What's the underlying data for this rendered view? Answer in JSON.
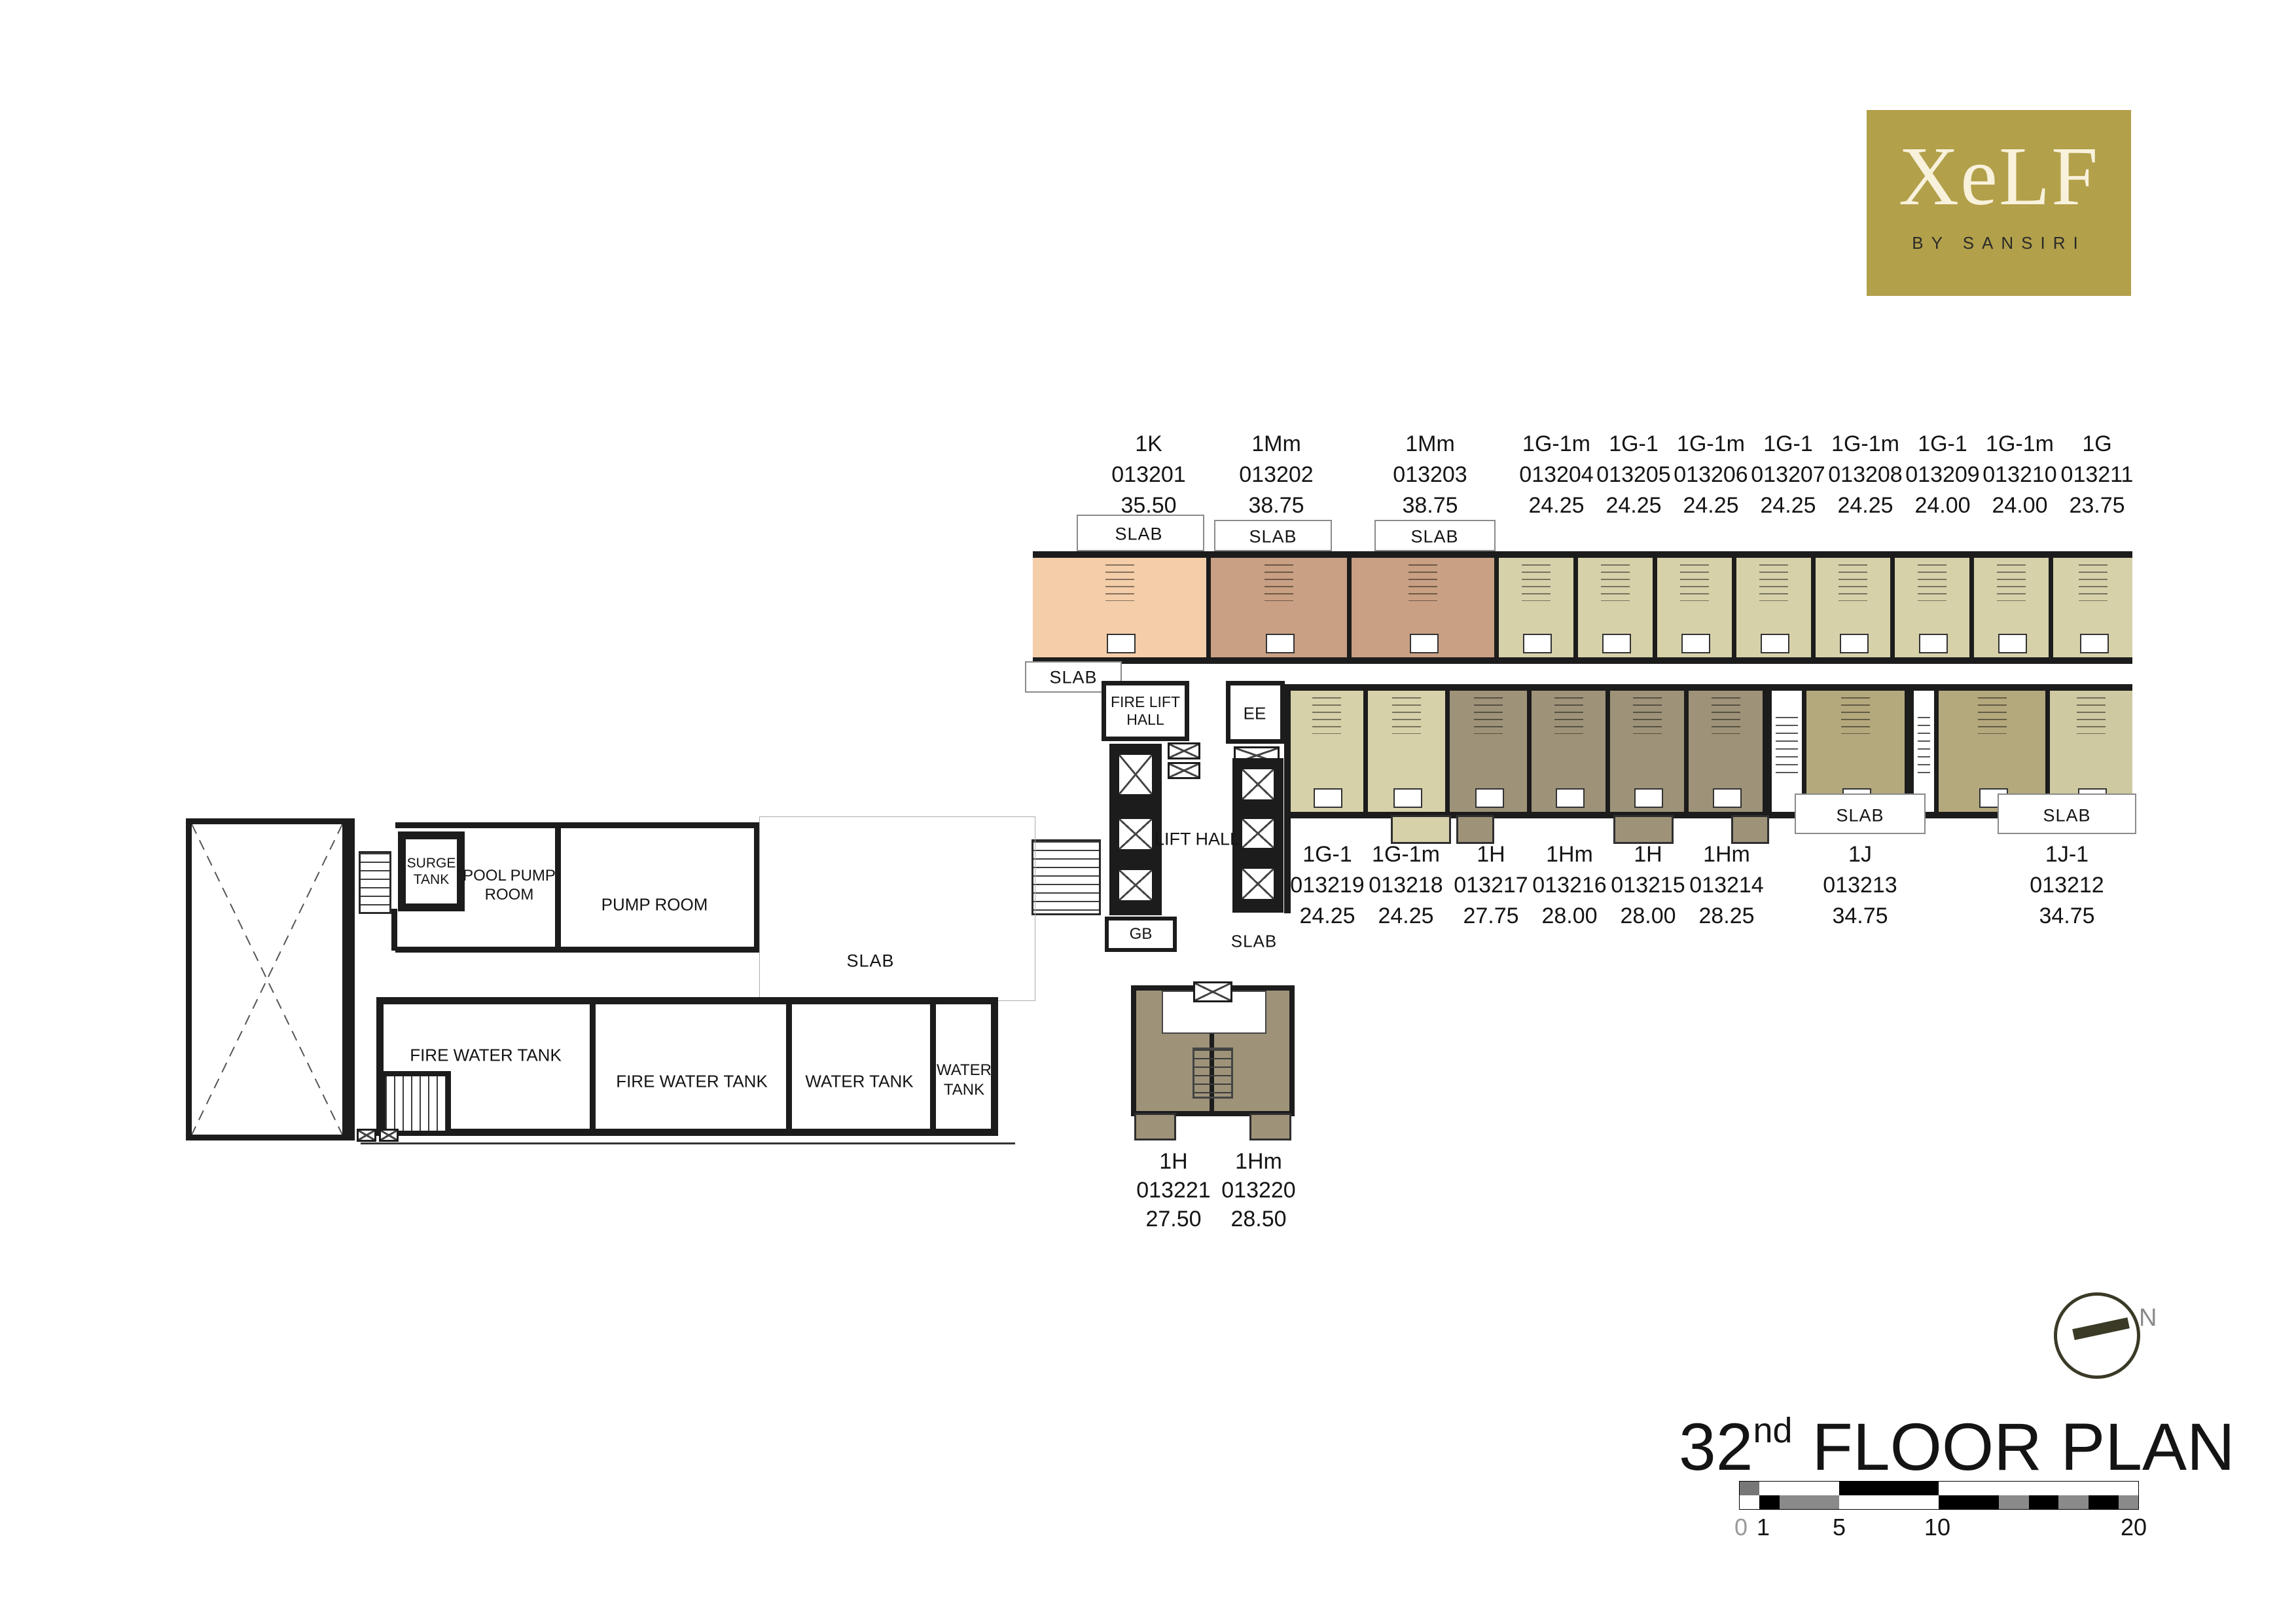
{
  "logo": {
    "brand": "XeLF",
    "sub": "BY SANSIRI"
  },
  "title": {
    "number": "32",
    "suffix": "nd",
    "text": "FLOOR PLAN"
  },
  "compass": {
    "label": "N"
  },
  "scale_bar": {
    "ticks": [
      "0",
      "1",
      "5",
      "10",
      "20"
    ]
  },
  "rooms": {
    "slab": "SLAB",
    "fire_lift_hall_1": "FIRE LIFT",
    "fire_lift_hall_2": "HALL",
    "ee": "EE",
    "lift_hall": "LIFT HALL",
    "gb": "GB",
    "surge_1": "SURGE",
    "surge_2": "TANK",
    "pool_pump_1": "POOL PUMP",
    "pool_pump_2": "ROOM",
    "pump_room": "PUMP ROOM",
    "fire_water_tank": "FIRE WATER TANK",
    "water_tank": "WATER TANK",
    "water_tank_1": "WATER",
    "water_tank_2": "TANK"
  },
  "units": [
    {
      "type": "1K",
      "id": "013201",
      "area": "35.50"
    },
    {
      "type": "1Mm",
      "id": "013202",
      "area": "38.75"
    },
    {
      "type": "1Mm",
      "id": "013203",
      "area": "38.75"
    },
    {
      "type": "1G-1m",
      "id": "013204",
      "area": "24.25"
    },
    {
      "type": "1G-1",
      "id": "013205",
      "area": "24.25"
    },
    {
      "type": "1G-1m",
      "id": "013206",
      "area": "24.25"
    },
    {
      "type": "1G-1",
      "id": "013207",
      "area": "24.25"
    },
    {
      "type": "1G-1m",
      "id": "013208",
      "area": "24.25"
    },
    {
      "type": "1G-1",
      "id": "013209",
      "area": "24.00"
    },
    {
      "type": "1G-1m",
      "id": "013210",
      "area": "24.00"
    },
    {
      "type": "1G",
      "id": "013211",
      "area": "23.75"
    },
    {
      "type": "1G-1",
      "id": "013219",
      "area": "24.25"
    },
    {
      "type": "1G-1m",
      "id": "013218",
      "area": "24.25"
    },
    {
      "type": "1H",
      "id": "013217",
      "area": "27.75"
    },
    {
      "type": "1Hm",
      "id": "013216",
      "area": "28.00"
    },
    {
      "type": "1H",
      "id": "013215",
      "area": "28.00"
    },
    {
      "type": "1Hm",
      "id": "013214",
      "area": "28.25"
    },
    {
      "type": "1J",
      "id": "013213",
      "area": "34.75"
    },
    {
      "type": "1J-1",
      "id": "013212",
      "area": "34.75"
    },
    {
      "type": "1H",
      "id": "013221",
      "area": "27.50"
    },
    {
      "type": "1Hm",
      "id": "013220",
      "area": "28.50"
    }
  ],
  "colors": {
    "logo_gold": "#b2a04b",
    "logo_cream": "#f8f1db",
    "unit_1k": "#f4cda9",
    "unit_1mm": "#c9a083",
    "unit_1g": "#d7d1aa",
    "unit_1h": "#9e9379",
    "unit_1j": "#b4a87d",
    "wall": "#1c1c1c",
    "compass_olive": "#3a3a26",
    "outline_gray": "#8a8a8a"
  }
}
